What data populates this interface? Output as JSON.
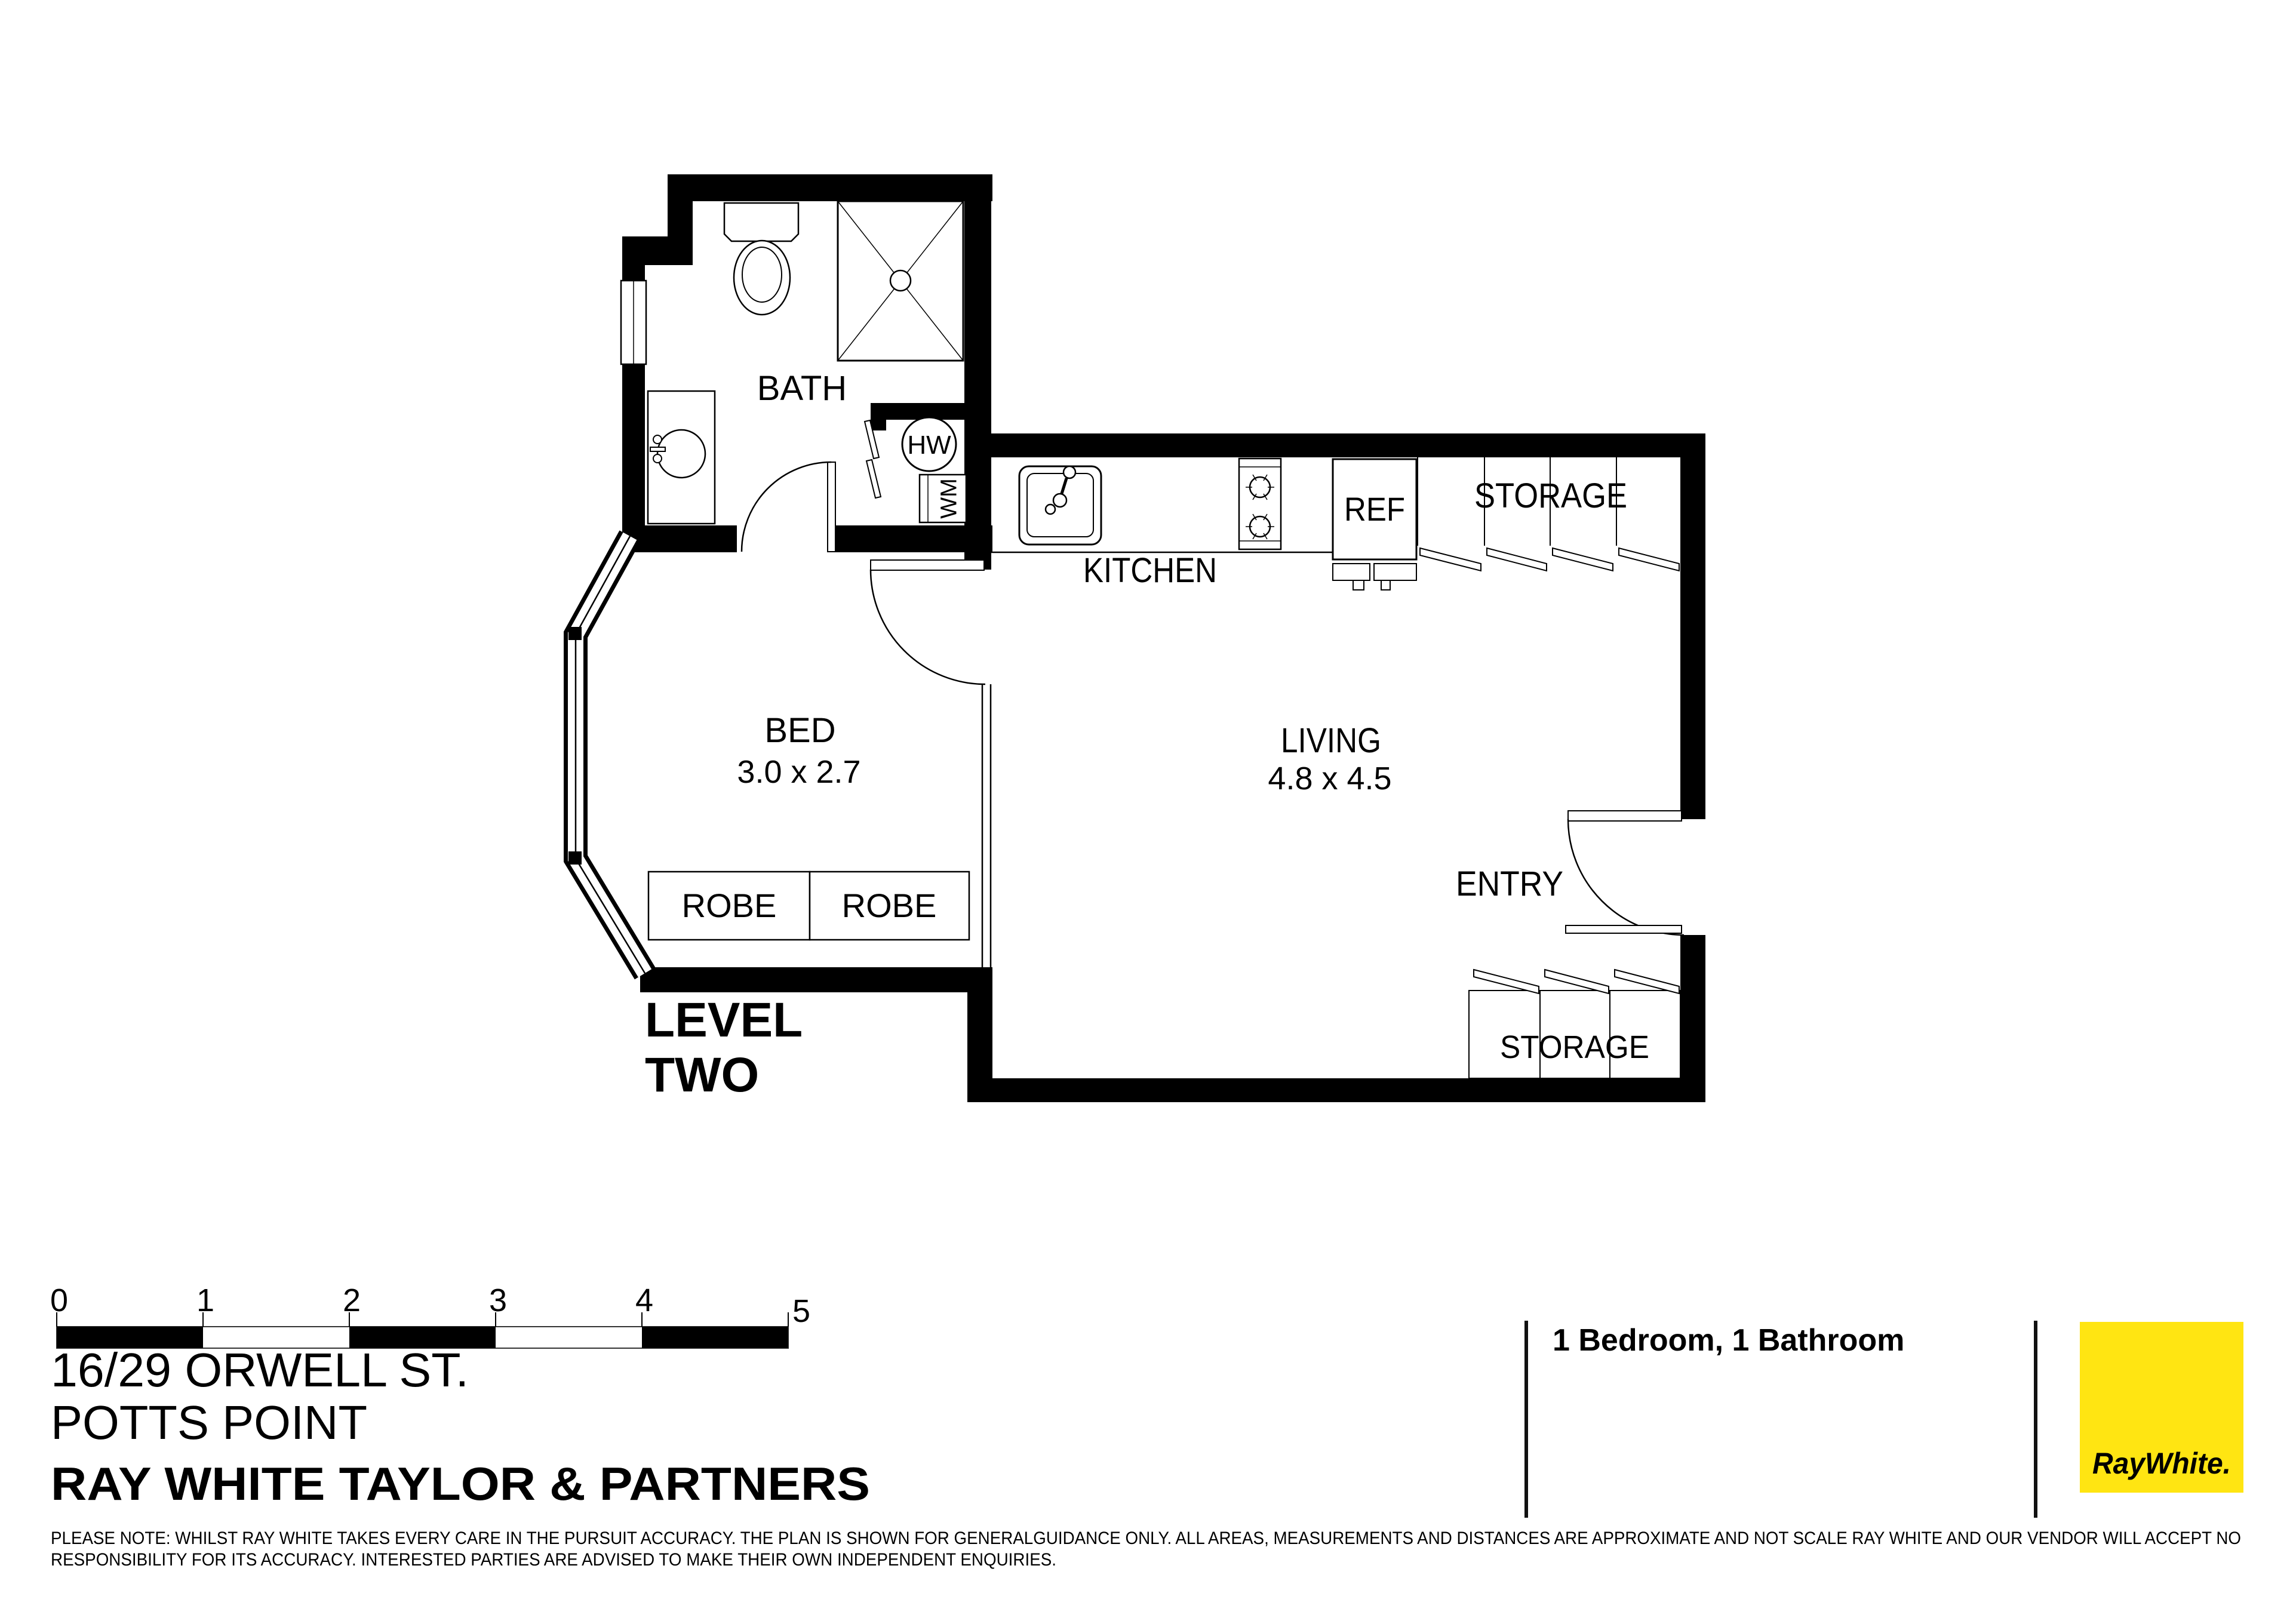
{
  "colors": {
    "wall_black": "#000000",
    "logo_yellow": "#FFE512",
    "logo_text_gray": "#58595B",
    "agency_gray": "#3A3A39"
  },
  "plan": {
    "labels": {
      "bath": "BATH",
      "kitchen": "KITCHEN",
      "bed": "BED",
      "bed_dims": "3.0 x 2.7",
      "living": "LIVING",
      "living_dims": "4.8 x 4.5",
      "entry": "ENTRY",
      "robe_left": "ROBE",
      "robe_right": "ROBE",
      "storage_top": "STORAGE",
      "storage_bottom": "STORAGE",
      "ref": "REF",
      "hw": "HW",
      "wm": "WM",
      "level_line1": "LEVEL",
      "level_line2": "TWO"
    },
    "rooms": [
      {
        "name": "BED",
        "dimensions": "3.0 x 2.7"
      },
      {
        "name": "LIVING",
        "dimensions": "4.8 x 4.5"
      },
      {
        "name": "BATH",
        "dimensions": ""
      },
      {
        "name": "KITCHEN",
        "dimensions": ""
      }
    ]
  },
  "scale_bar": {
    "labels": [
      "0",
      "1",
      "2",
      "3",
      "4",
      "5"
    ]
  },
  "footer": {
    "address_line1": "16/29 ORWELL ST.",
    "address_line2": "POTTS POINT",
    "agency": "RAY WHITE TAYLOR & PARTNERS",
    "summary": "1 Bedroom, 1 Bathroom",
    "disclaimer_line1": "PLEASE NOTE: WHILST RAY WHITE TAKES EVERY CARE IN THE PURSUIT ACCURACY. THE PLAN IS SHOWN FOR GENERALGUIDANCE ONLY. ALL AREAS, MEASUREMENTS AND DISTANCES ARE APPROXIMATE AND NOT SCALE RAY WHITE AND OUR VENDOR WILL ACCEPT NO",
    "disclaimer_line2": "RESPONSIBILITY FOR ITS ACCURACY. INTERESTED PARTIES ARE ADVISED TO MAKE THEIR OWN INDEPENDENT ENQUIRIES.",
    "logo_text": "RayWhite."
  }
}
